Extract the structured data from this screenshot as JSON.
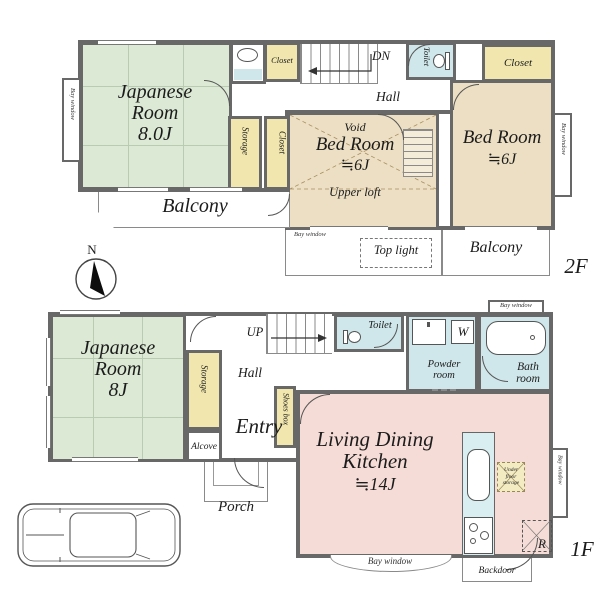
{
  "common": {
    "bay_window": "Bay window",
    "balcony": "Balcony",
    "closet": "Closet",
    "storage": "Storage",
    "hall": "Hall",
    "toilet": "Toilet",
    "bed_room": "Bed Room",
    "six_j": "≒6J"
  },
  "compass": {
    "north": "N"
  },
  "floor2": {
    "label": "2F",
    "japanese_room": {
      "l1": "Japanese",
      "l2": "Room",
      "l3": "8.0J"
    },
    "stairs_direction": "DN",
    "bedroom_mid": {
      "void": "Void",
      "loft": "Upper loft"
    },
    "top_light": "Top light"
  },
  "floor1": {
    "label": "1F",
    "japanese_room": {
      "l1": "Japanese",
      "l2": "Room",
      "l3": "8J"
    },
    "stairs_direction": "UP",
    "entry": "Entry",
    "alcove": "Alcove",
    "shoes_box": "Shoes box",
    "porch": "Porch",
    "powder_room": {
      "l1": "Powder",
      "l2": "room"
    },
    "washer": "W",
    "bath_room": {
      "l1": "Bath",
      "l2": "room"
    },
    "ldk": {
      "l1": "Living Dining",
      "l2": "Kitchen",
      "l3": "≒14J"
    },
    "under_floor_storage": {
      "l1": "Under",
      "l2": "floor",
      "l3": "storage"
    },
    "refrigerator": "R",
    "backdoor": "Backdoor"
  },
  "colors": {
    "wall": "#686868",
    "tatami_room": "#dcead5",
    "bedroom": "#ecdfc3",
    "closet": "#f0e6ae",
    "wet_area": "#cfe7ea",
    "ldk": "#f5dcd6",
    "counter": "#d9eef0"
  }
}
